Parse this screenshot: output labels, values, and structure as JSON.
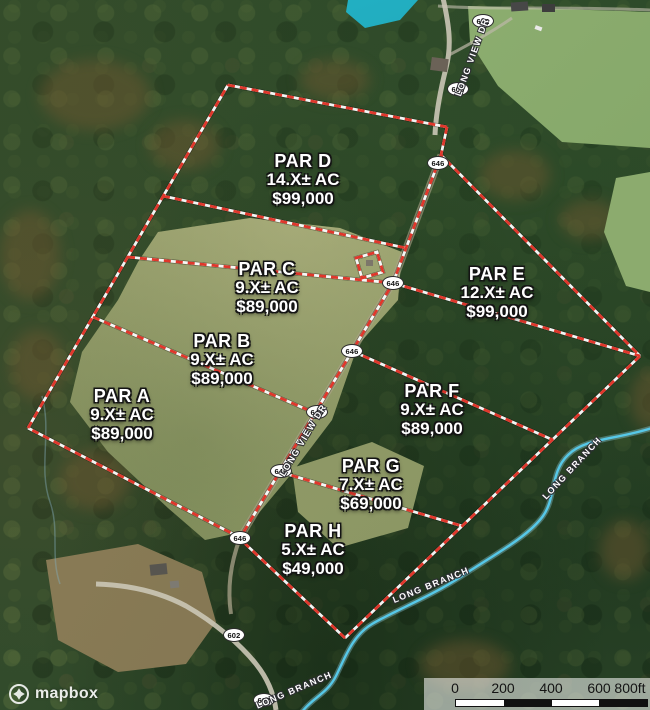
{
  "map": {
    "parcels": [
      {
        "name": "PAR D",
        "acreage": "14.X± AC",
        "price": "$99,000"
      },
      {
        "name": "PAR C",
        "acreage": "9.X± AC",
        "price": "$89,000"
      },
      {
        "name": "PAR E",
        "acreage": "12.X± AC",
        "price": "$99,000"
      },
      {
        "name": "PAR B",
        "acreage": "9.X± AC",
        "price": "$89,000"
      },
      {
        "name": "PAR A",
        "acreage": "9.X± AC",
        "price": "$89,000"
      },
      {
        "name": "PAR F",
        "acreage": "9.X± AC",
        "price": "$89,000"
      },
      {
        "name": "PAR G",
        "acreage": "7.X± AC",
        "price": "$69,000"
      },
      {
        "name": "PAR H",
        "acreage": "5.X± AC",
        "price": "$49,000"
      }
    ],
    "road_labels": {
      "long_view_dr": "LONG VIEW DR",
      "long_branch": "LONG BRANCH"
    },
    "route_shields": [
      {
        "number": "602"
      },
      {
        "number": "603"
      },
      {
        "number": "646"
      },
      {
        "number": "646"
      },
      {
        "number": "646"
      },
      {
        "number": "646"
      },
      {
        "number": "646"
      },
      {
        "number": "646"
      },
      {
        "number": "602"
      },
      {
        "number": "602"
      }
    ],
    "colors": {
      "parcel_line": "#e0372b",
      "stream": "#56c8e8",
      "label_text": "#ffffff",
      "forest": "#2f4b2b",
      "field": "#99a26d"
    }
  },
  "scale_bar": {
    "labels": [
      "0",
      "200",
      "400",
      "600",
      "800ft"
    ]
  },
  "branding": {
    "logo_text": "mapbox"
  }
}
